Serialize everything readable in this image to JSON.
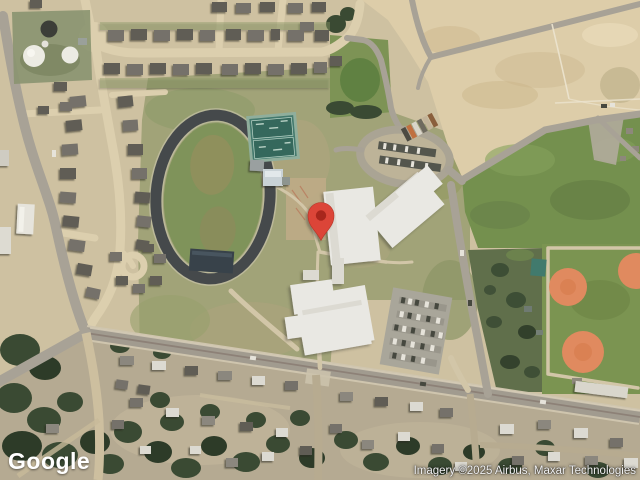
{
  "map": {
    "marker_color": "#dc4437",
    "marker_inner_color": "#a8271c"
  },
  "footer": {
    "logo": "Google",
    "attribution": "Imagery ©2025 Airbus, Maxar Technologies"
  }
}
